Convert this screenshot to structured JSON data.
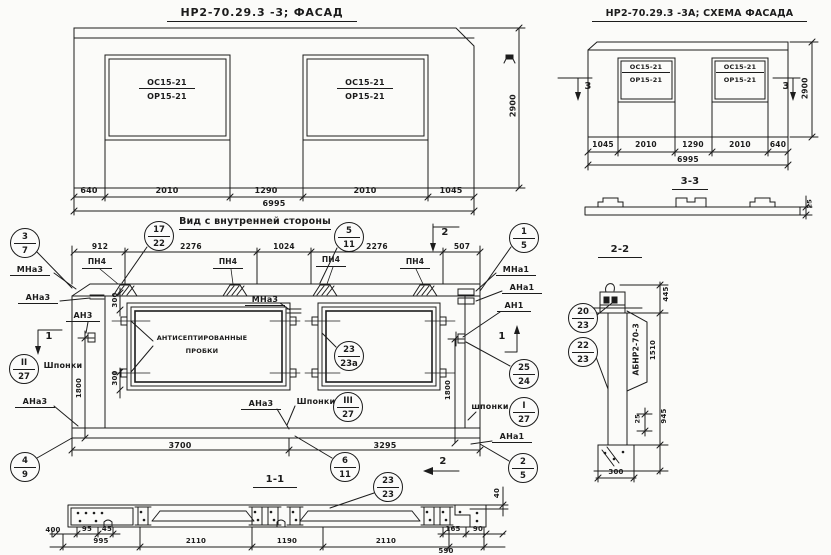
{
  "colors": {
    "ink": "#1c1c1c",
    "paper": "#fbfbf9"
  },
  "facade": {
    "title": "НР2-70.29.3 -3;  ФАСАД",
    "win_top": "ОС15-21",
    "win_bot": "ОР15-21",
    "d1": "640",
    "d2": "2010",
    "d3": "1290",
    "d4": "2010",
    "d5": "1045",
    "total": "6995",
    "height": "2900"
  },
  "schema": {
    "title": "НР2-70.29.3 -3А; СХЕМА ФАСАДА",
    "win_top": "ОС15-21",
    "win_bot": "ОР15-21",
    "d1": "1045",
    "d2": "2010",
    "d3": "1290",
    "d4": "2010",
    "d5": "640",
    "total": "6995",
    "height": "2900",
    "cut_mark": "3",
    "section_label": "3-3",
    "profile_dim": "25"
  },
  "main": {
    "title": "Вид с внутренней стороны",
    "td1": "912",
    "td2": "2276",
    "td3": "1024",
    "td4": "2276",
    "td5": "507",
    "loop": "ПН4",
    "mna3": "МНа3",
    "ana3": "АНа3",
    "an3": "АН3",
    "mna1": "МНа1",
    "ana1": "АНа1",
    "an1": "АН1",
    "keys": "Шпонки",
    "keys_lc": "шпонки",
    "note1": "АНТИСЕПТИРОВАННЫЕ",
    "note2": "ПРОБКИ",
    "d300": "300",
    "d1800": "1800",
    "bd1": "3700",
    "bd2": "3295",
    "cut1": "1",
    "cut2": "2"
  },
  "s11": {
    "label": "1-1",
    "d400": "400",
    "d95": "95",
    "d45": "45",
    "d995": "995",
    "d2110": "2110",
    "d1190": "1190",
    "d590": "590",
    "d165": "165",
    "d90": "90",
    "d40": "40"
  },
  "s22": {
    "label": "2-2",
    "stamp": "АБНР2-70-3",
    "d445": "445",
    "d1510": "1510",
    "d945": "945",
    "d25": "25",
    "d300": "300"
  },
  "balloons": {
    "b3_7": {
      "t": "3",
      "b": "7"
    },
    "b17_22": {
      "t": "17",
      "b": "22"
    },
    "b5_11": {
      "t": "5",
      "b": "11"
    },
    "b1_5": {
      "t": "1",
      "b": "5"
    },
    "b25_24": {
      "t": "25",
      "b": "24"
    },
    "b2_5": {
      "t": "2",
      "b": "5"
    },
    "b4_9": {
      "t": "4",
      "b": "9"
    },
    "b6_11": {
      "t": "6",
      "b": "11"
    },
    "b23_23a": {
      "t": "23",
      "b": "23а"
    },
    "b2_27": {
      "t": "II",
      "b": "27"
    },
    "b3_27": {
      "t": "III",
      "b": "27"
    },
    "b1_27": {
      "t": "I",
      "b": "27"
    },
    "b23_23": {
      "t": "23",
      "b": "23"
    },
    "b20_23": {
      "t": "20",
      "b": "23"
    },
    "b22_23": {
      "t": "22",
      "b": "23"
    }
  }
}
